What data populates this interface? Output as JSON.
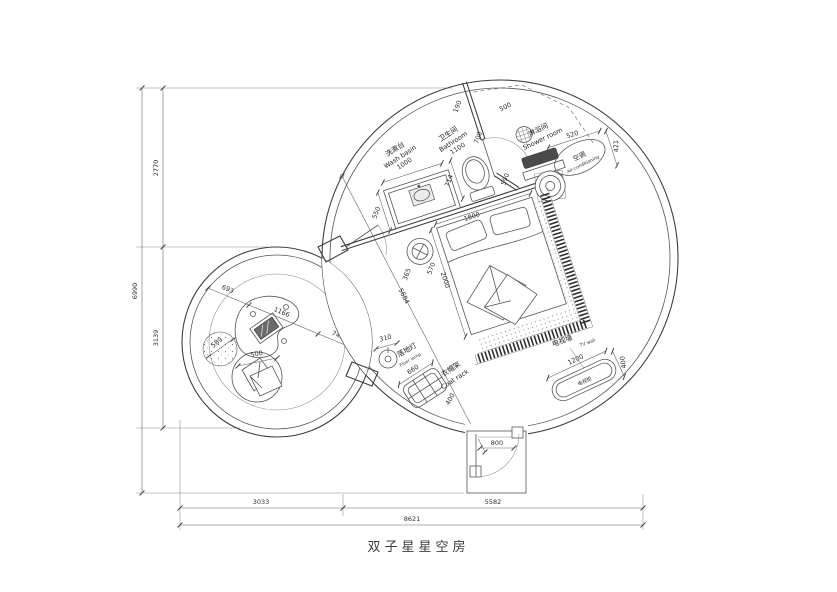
{
  "title": "双子星星空房",
  "rooms": {
    "washbasin": {
      "cn": "洗漱台",
      "en": "Wash basin"
    },
    "bathroom": {
      "cn": "卫生间",
      "en": "Bathroom"
    },
    "shower": {
      "cn": "淋浴间",
      "en": "Shower room"
    },
    "ac": {
      "cn": "空调",
      "en": "Air-conditioning"
    },
    "floor_lamp": {
      "cn": "落地灯",
      "en": "Floor lamp"
    },
    "coat_rack": {
      "cn": "衣帽架",
      "en": "Coat rack"
    },
    "tv_wall": {
      "cn": "电视墙",
      "en": "TV wall"
    },
    "tv_cabinet": {
      "cn": "电视柜"
    }
  },
  "dims": {
    "height_total": "6990",
    "height_upper": "2770",
    "height_lower": "3139",
    "width_total": "8621",
    "width_left": "3033",
    "width_right": "5582",
    "wall_top": "190",
    "bath_door": "700",
    "shower_door": "500",
    "wall_mid": "590",
    "bathroom_w": "1100",
    "washbasin_l": "1000",
    "counter_d": "550",
    "toilet_c": "714",
    "bed_w": "1800",
    "bed_l": "2000",
    "stool_a": "365",
    "stool_b": "570",
    "diag": "5684",
    "lamp": "310",
    "rack_w": "660",
    "rack_d": "400",
    "tv_l": "1200",
    "tv_d": "400",
    "ac_w": "520",
    "ac_d": "421",
    "entry": "800",
    "left_a": "693",
    "left_b": "1166",
    "left_c": "745",
    "side_table": "589",
    "ottoman": "500"
  },
  "colors": {
    "line": "#3f3f3f",
    "dim": "#666666"
  }
}
